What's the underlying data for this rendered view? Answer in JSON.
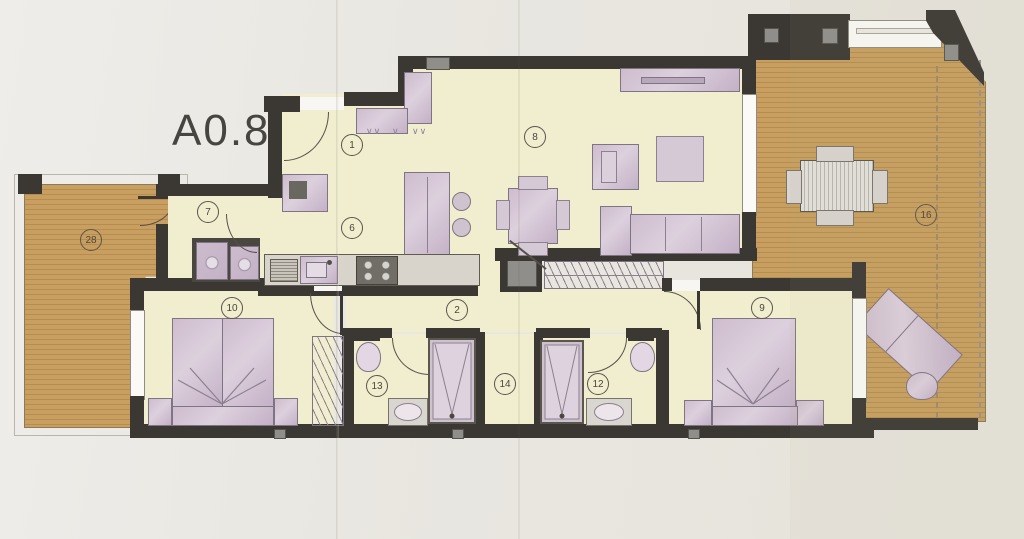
{
  "title": "A0.8",
  "labels": {
    "entry": "1",
    "hallway": "2",
    "kitchen": "6",
    "utility": "7",
    "living": "8",
    "bedroom_right": "9",
    "bedroom_left": "10",
    "bathroom_right": "12",
    "bathroom_left": "13",
    "inner_hall": "14",
    "terrace_right": "16",
    "terrace_left": "28"
  },
  "colors": {
    "paper": "#e9e7e1",
    "floor": "#f0eecf",
    "wall": "#3b3834",
    "furniture": "#cbbacc",
    "wood_deck": "#c89f60",
    "counter": "#d8d4cb"
  }
}
